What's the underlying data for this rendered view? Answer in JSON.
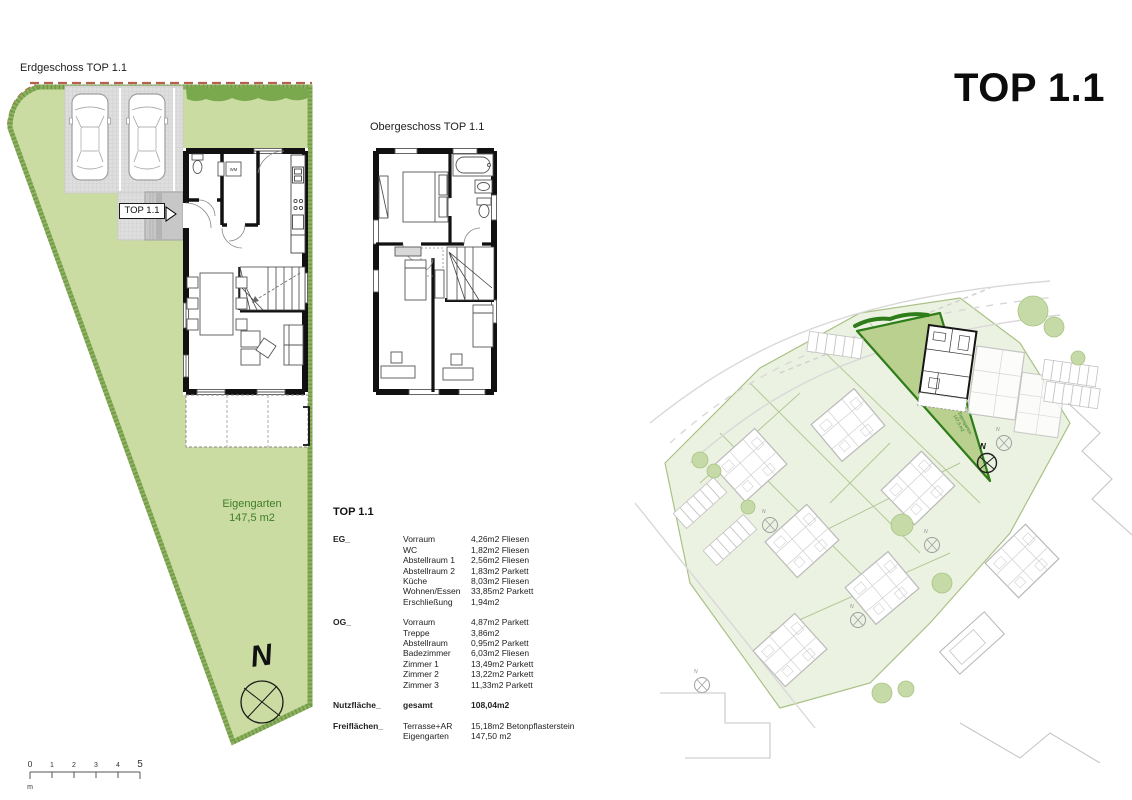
{
  "page": {
    "title_main": "TOP 1.1"
  },
  "plans": {
    "erdgeschoss_label": "Erdgeschoss TOP 1.1",
    "obergeschoss_label": "Obergeschoss TOP 1.1",
    "entrance_label": "TOP 1.1",
    "garden_label_line1": "Eigengarten",
    "garden_label_line2": "147,5 m2",
    "north_letter": "N",
    "wm_label": "WM"
  },
  "area_table": {
    "title": "TOP 1.1",
    "rows": [
      {
        "key": "EG_",
        "name": "Vorraum",
        "value": "4,26m2 Fliesen"
      },
      {
        "name": "WC",
        "value": "1,82m2 Fliesen"
      },
      {
        "name": "Abstellraum 1",
        "value": "2,56m2 Fliesen"
      },
      {
        "name": "Abstellraum 2",
        "value": "1,83m2 Parkett"
      },
      {
        "name": "Küche",
        "value": "8,03m2 Fliesen"
      },
      {
        "name": "Wohnen/Essen",
        "value": "33,85m2 Parkett"
      },
      {
        "name": "Erschließung",
        "value": "1,94m2"
      },
      {
        "key": "OG_",
        "name": "Vorraum",
        "value": "4,87m2 Parkett",
        "flags": "gap"
      },
      {
        "name": "Treppe",
        "value": "3,86m2"
      },
      {
        "name": "Abstellraum",
        "value": "0,95m2 Parkett"
      },
      {
        "name": "Badezimmer",
        "value": "6,03m2 Fliesen"
      },
      {
        "name": "Zimmer 1",
        "value": "13,49m2 Parkett"
      },
      {
        "name": "Zimmer 2",
        "value": "13,22m2 Parkett"
      },
      {
        "name": "Zimmer 3",
        "value": "11,33m2 Parkett"
      },
      {
        "key": "Nutzfläche_",
        "name": "gesamt",
        "value": "108,04m2",
        "flags": "gap bold"
      },
      {
        "key": "Freiflächen_",
        "name": "Terrasse+AR",
        "value": "15,18m2 Betonpflasterstein",
        "flags": "gap"
      },
      {
        "name": "Eigengarten",
        "value": "147,50 m2"
      }
    ]
  },
  "scale_bar": {
    "ticks": [
      "0",
      "1",
      "2",
      "3",
      "4",
      "5"
    ],
    "unit": "m"
  },
  "colors": {
    "garden_fill": "#cadca1",
    "garden_border": "#8caf60",
    "hedge": "#79a94c",
    "highlight_parcel_fill": "#b9d08f",
    "highlight_parcel_border": "#2e7d19",
    "boundary_red": "#b5604d",
    "paving": "#dedede",
    "wall_black": "#111111",
    "faded_gray": "#b9b9b9",
    "site_parcel_fill": "#ecf2e2",
    "green_text": "#3f7d2a"
  }
}
